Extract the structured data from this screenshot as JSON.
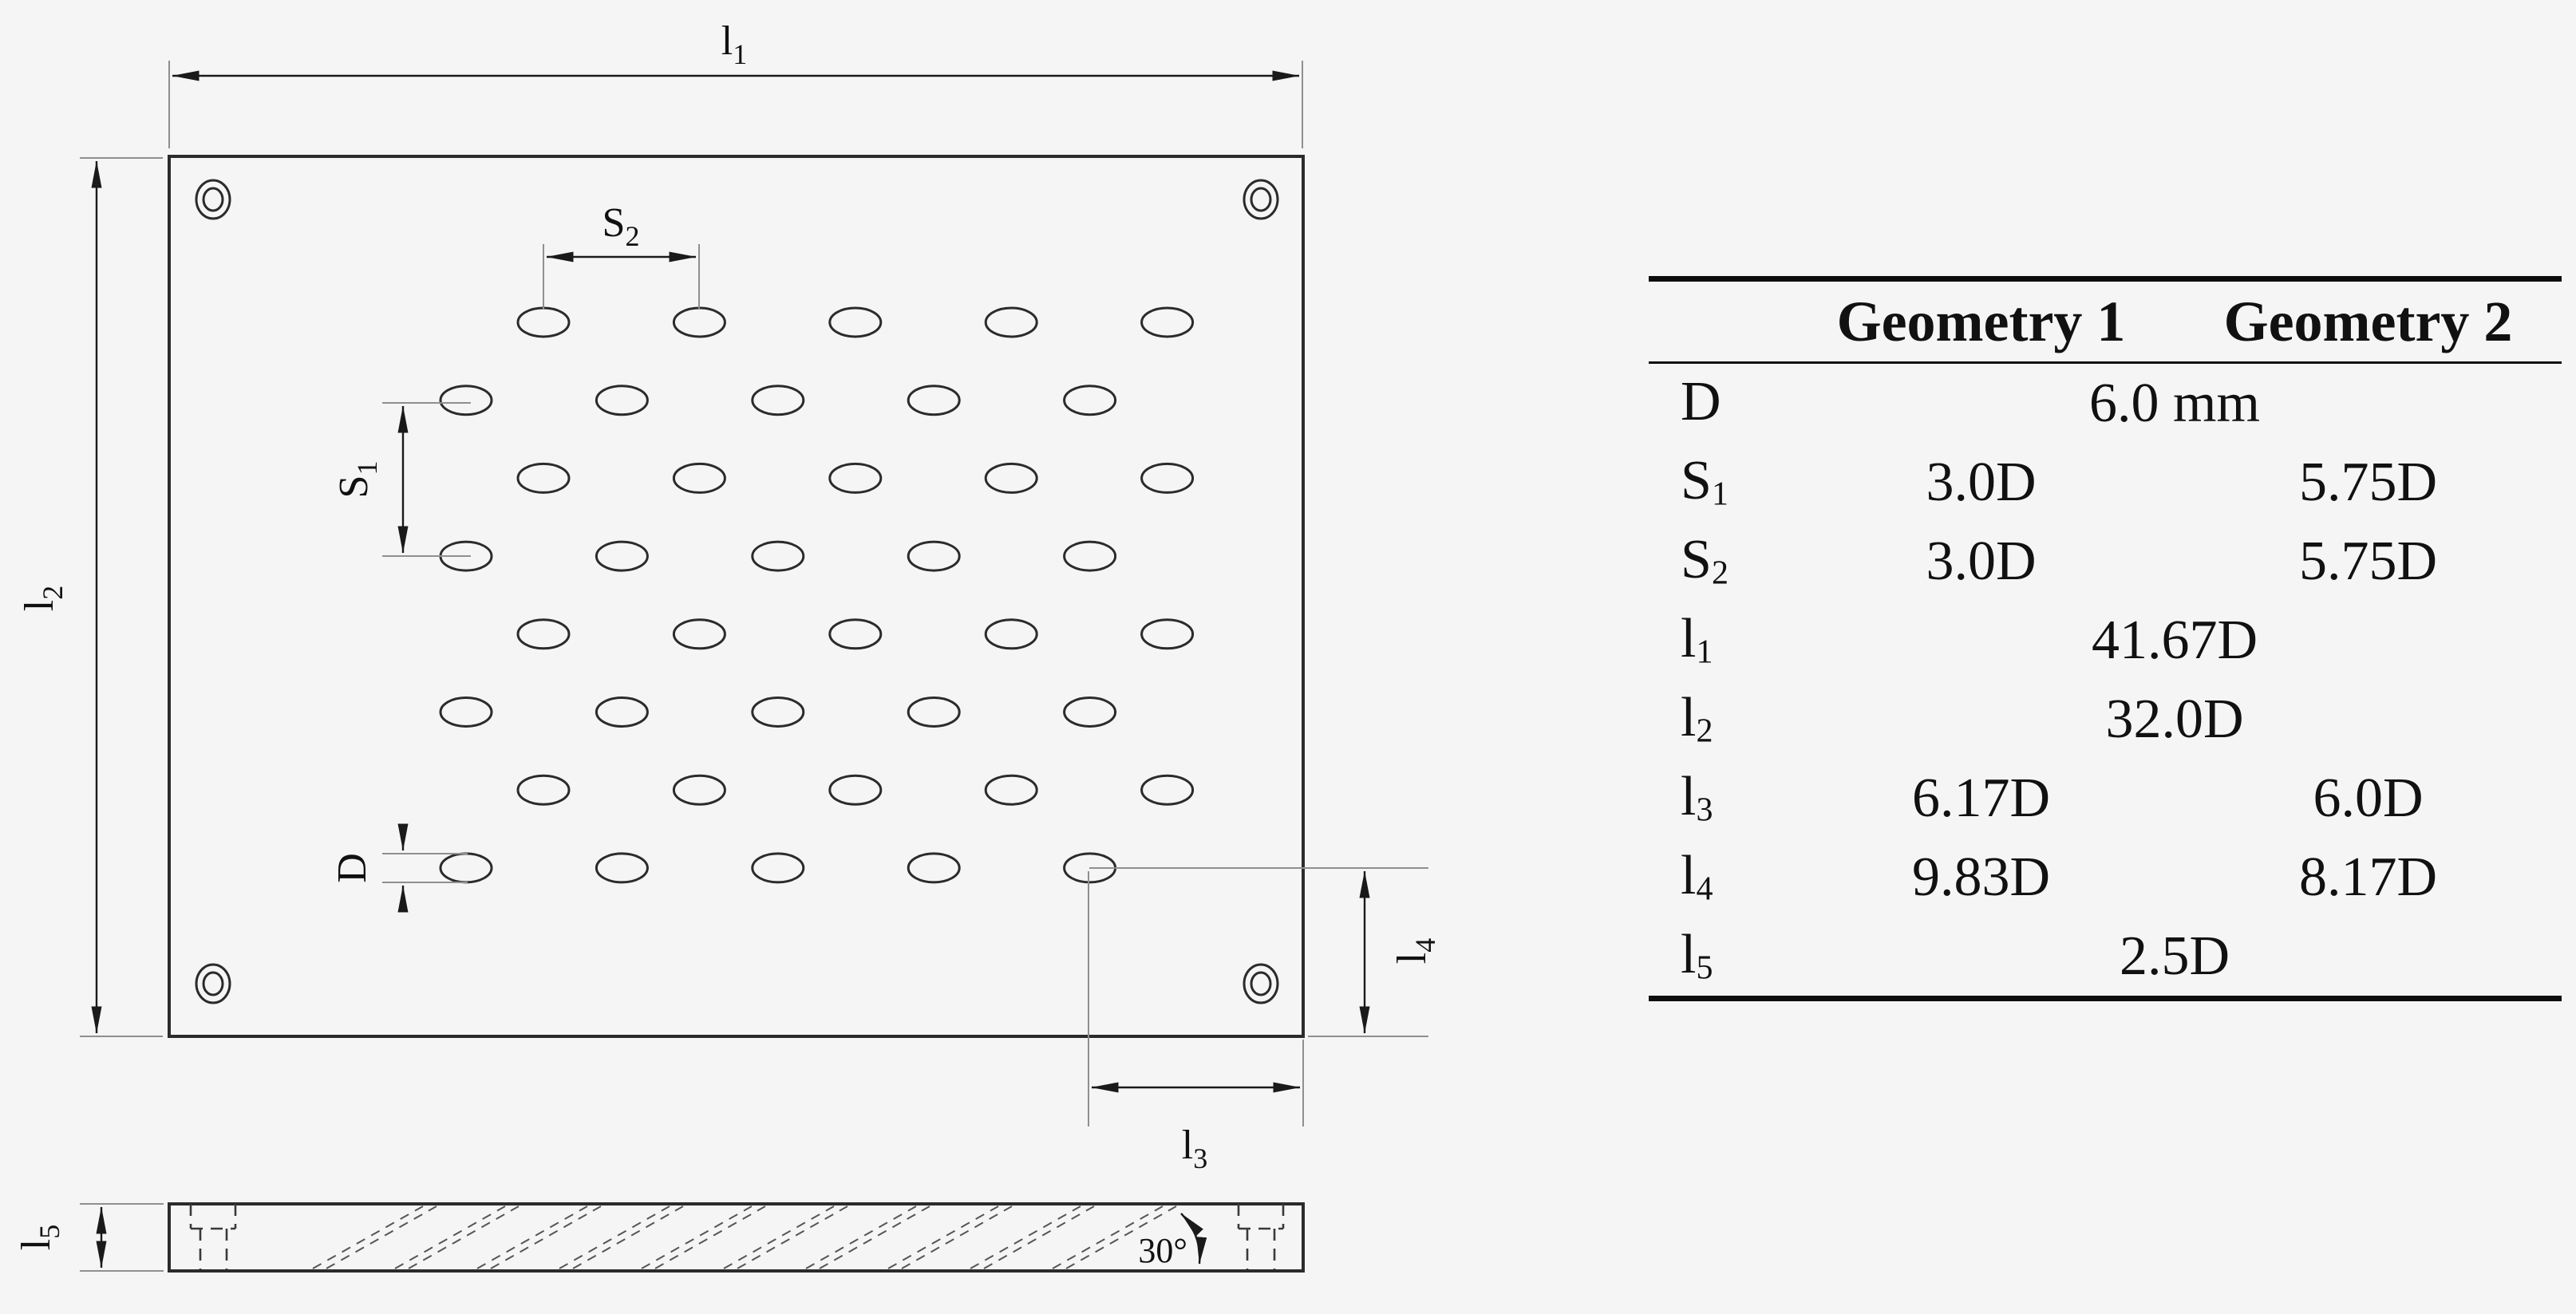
{
  "figure": {
    "description": "Technical drawing of perforated plate (top view and sectioned side view) with dimension table",
    "colors": {
      "background": "#f5f5f5",
      "line": "#2b2b2b",
      "extension_line": "#8f8f8f",
      "text": "#111111"
    }
  },
  "diagram": {
    "labels": {
      "l1": {
        "base": "l",
        "sub": "1"
      },
      "l2": {
        "base": "l",
        "sub": "2"
      },
      "l3": {
        "base": "l",
        "sub": "3"
      },
      "l4": {
        "base": "l",
        "sub": "4"
      },
      "l5": {
        "base": "l",
        "sub": "5"
      },
      "s1": {
        "base": "S",
        "sub": "1"
      },
      "s2": {
        "base": "S",
        "sub": "2"
      },
      "d": {
        "base": "D",
        "sub": ""
      },
      "angle": "30°"
    },
    "hole_grid": {
      "rows": 8,
      "holes_per_row": 5,
      "pattern": "staggered"
    }
  },
  "table": {
    "col_headers": [
      "Geometry 1",
      "Geometry 2"
    ],
    "rows": [
      {
        "label": {
          "base": "D",
          "sub": ""
        },
        "type": "span",
        "value": "6.0 mm"
      },
      {
        "label": {
          "base": "S",
          "sub": "1"
        },
        "type": "two",
        "g1": "3.0D",
        "g2": "5.75D"
      },
      {
        "label": {
          "base": "S",
          "sub": "2"
        },
        "type": "two",
        "g1": "3.0D",
        "g2": "5.75D"
      },
      {
        "label": {
          "base": "l",
          "sub": "1"
        },
        "type": "span",
        "value": "41.67D"
      },
      {
        "label": {
          "base": "l",
          "sub": "2"
        },
        "type": "span",
        "value": "32.0D"
      },
      {
        "label": {
          "base": "l",
          "sub": "3"
        },
        "type": "two",
        "g1": "6.17D",
        "g2": "6.0D"
      },
      {
        "label": {
          "base": "l",
          "sub": "4"
        },
        "type": "two",
        "g1": "9.83D",
        "g2": "8.17D"
      },
      {
        "label": {
          "base": "l",
          "sub": "5"
        },
        "type": "span",
        "value": "2.5D"
      }
    ]
  }
}
